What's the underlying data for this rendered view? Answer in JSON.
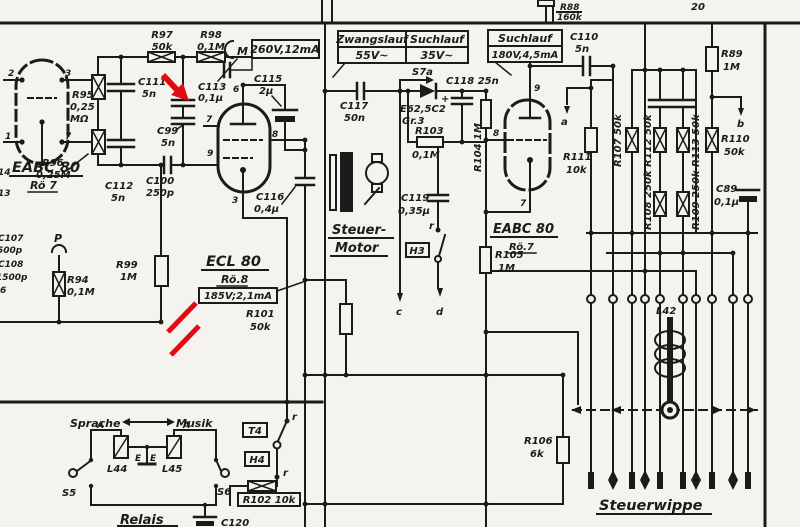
{
  "palette": {
    "paper": "#f5f3ee",
    "ink": "#1b1b1b",
    "red": "#e30b13"
  },
  "boxes": {
    "v260": "260V,12mA",
    "v185": "185V;2,1mA",
    "table_col1_header": "Zwangslauf",
    "table_col2_header": "Suchlauf",
    "table_col1_value": "55V~",
    "table_col2_value": "35V~",
    "suchlauf_header": "Suchlauf",
    "suchlauf_value": "180V,4,5mA"
  },
  "tubes": {
    "left": {
      "name": "EABC 80",
      "ref": "Rö 7",
      "pins": [
        "2",
        "3",
        "1",
        "7"
      ]
    },
    "mid": {
      "name": "ECL 80",
      "ref": "Rö.8",
      "pins": [
        "6",
        "7",
        "9",
        "8",
        "3"
      ]
    },
    "right": {
      "name": "EABC 80",
      "ref": "Rö.7",
      "pins": [
        "9",
        "8",
        "7"
      ]
    }
  },
  "resistors": {
    "r88": {
      "name": "R88",
      "value": "160k"
    },
    "r89": {
      "name": "R89",
      "value": "1M"
    },
    "r94": {
      "name": "R94",
      "value": "0,1M"
    },
    "r95": {
      "name": "R95",
      "value": "0,25",
      "unit": "MΩ"
    },
    "r96": {
      "name": "R96",
      "value": "0,25M"
    },
    "r97": {
      "name": "R97",
      "value": "50k"
    },
    "r98": {
      "name": "R98",
      "value": "0,1M"
    },
    "r99": {
      "name": "R99",
      "value": "1M"
    },
    "r101": {
      "name": "R101",
      "value": "50k"
    },
    "r102": {
      "label": "R102 10k"
    },
    "r103": {
      "name": "R103",
      "value": "0,1M"
    },
    "r104": {
      "label": "R104 1M"
    },
    "r105": {
      "name": "R105",
      "value": "1M"
    },
    "r106": {
      "name": "R106",
      "value": "6k"
    },
    "r107": {
      "label": "R107 50k"
    },
    "r108": {
      "label": "R108 250k"
    },
    "r109": {
      "label": "R109 250k"
    },
    "r110": {
      "name": "R110",
      "value": "50k"
    },
    "r111": {
      "name": "R111",
      "value": "10k"
    },
    "r112": {
      "label": "R112 50k"
    },
    "r113": {
      "label": "R113 50k"
    }
  },
  "capacitors": {
    "c89": {
      "name": "C89",
      "value": "0,1µ"
    },
    "c99": {
      "name": "C99",
      "value": "5n"
    },
    "c100": {
      "name": "C100",
      "value": "250p"
    },
    "c110": {
      "name": "C110",
      "value": "5n"
    },
    "c111": {
      "name": "C111",
      "value": "5n"
    },
    "c112": {
      "name": "C112",
      "value": "5n"
    },
    "c113": {
      "name": "C113",
      "value": "0,1µ"
    },
    "c115": {
      "name": "C115",
      "value": "2µ"
    },
    "c116": {
      "name": "C116",
      "value": "0,4µ"
    },
    "c117": {
      "name": "C117",
      "value": "50n"
    },
    "c118": {
      "label": "C118 25n"
    },
    "c119": {
      "name": "C119",
      "value": "0,35µ"
    },
    "c120": {
      "name": "C120"
    }
  },
  "semiconductors": {
    "diode": {
      "name": "E62,5C2",
      "group": "Gr.3",
      "polarity": "+"
    }
  },
  "coils": {
    "l42": "L42",
    "l44": "L44",
    "l45": "L45"
  },
  "switches": {
    "s5": "S5",
    "s6": "S6",
    "s7a": "S7a",
    "r_upper": "r",
    "r_lower": "r",
    "r_mid": "r"
  },
  "indicators": {
    "t4": "T4",
    "h4": "H4",
    "h3": "H3"
  },
  "labels": {
    "steuer_motor_1": "Steuer-",
    "steuer_motor_2": "Motor",
    "steuerwippe": "Steuerwippe",
    "relais": "Relais",
    "sprache": "Sprache",
    "musik": "Musik",
    "p": "P",
    "m": "M",
    "terminal_20": "20",
    "arrow_a": "a",
    "arrow_b": "b",
    "arrow_c": "c",
    "arrow_d": "d",
    "e_left": "E",
    "e_right": "E",
    "a_left": "A",
    "a_right": "A"
  },
  "edge_fragments": {
    "f1": "14",
    "f2": "13",
    "f3": "C107",
    "f4": "500p",
    "f5": "C108",
    "f6": "1500p",
    "f7": "6"
  }
}
